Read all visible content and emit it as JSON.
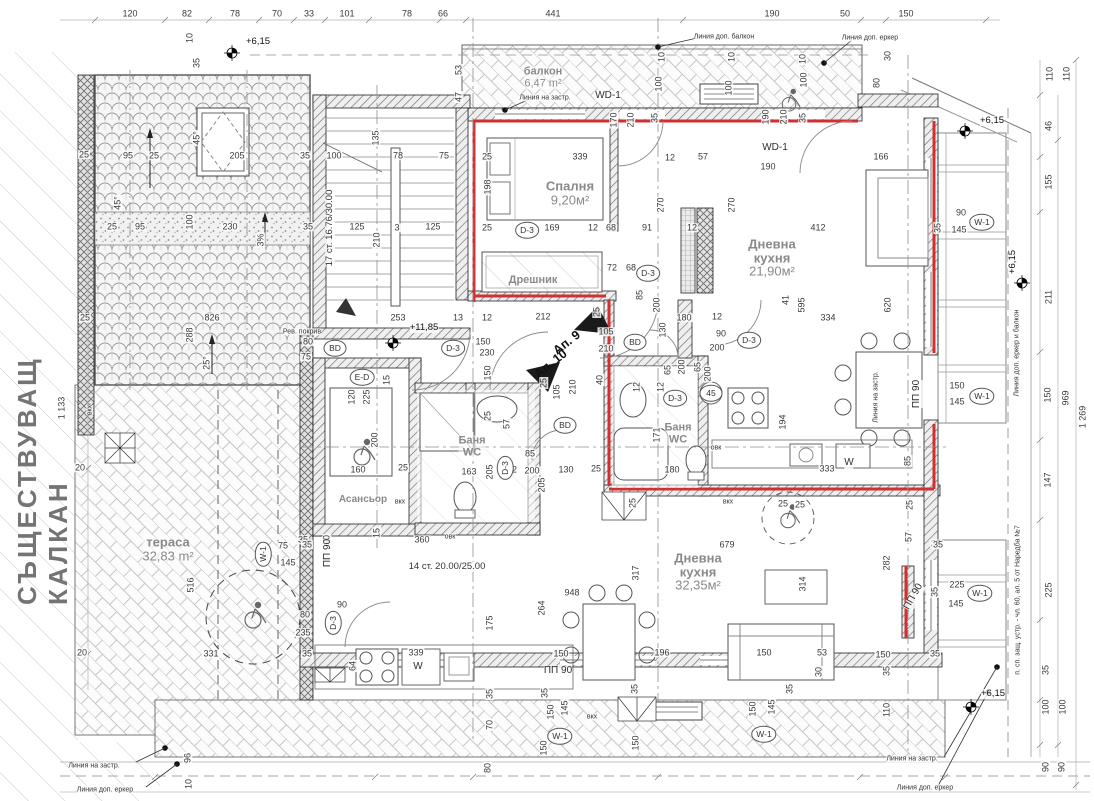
{
  "drawing": {
    "party_wall_label": "СЪЩЕСТВУВАЩ КАЛКАН"
  },
  "rooms": [
    {
      "name": "балкон",
      "area": "6,47 m²",
      "x": 543,
      "y": 78,
      "s": 11
    },
    {
      "name": "Спалня",
      "area": "9,20м²",
      "x": 570,
      "y": 193,
      "s": 13
    },
    {
      "name": "Дрешник",
      "area": "",
      "x": 533,
      "y": 281,
      "s": 11
    },
    {
      "name": "Дневна\nкухня",
      "area": "21,90м²",
      "x": 772,
      "y": 258,
      "s": 13
    },
    {
      "name": "Баня\nWC",
      "area": "",
      "x": 472,
      "y": 447,
      "s": 11
    },
    {
      "name": "Баня\nWC",
      "area": "",
      "x": 678,
      "y": 434,
      "s": 11
    },
    {
      "name": "Асансьор",
      "area": "",
      "x": 363,
      "y": 500,
      "s": 10
    },
    {
      "name": "тераса",
      "area": "32,83 m²",
      "x": 168,
      "y": 549,
      "s": 13
    },
    {
      "name": "Дневна\nкухня",
      "area": "32,35м²",
      "x": 698,
      "y": 572,
      "s": 13
    }
  ],
  "apartments": [
    {
      "label": "Ап. 9",
      "x": 567,
      "y": 343,
      "r": -38
    },
    {
      "label": "Ап. 10",
      "x": 551,
      "y": 364,
      "r": -38
    }
  ],
  "texts": [
    {
      "t": "17 ст. 16.76/30.00",
      "x": 330,
      "y": 228,
      "r": -90
    },
    {
      "t": "14 ст. 20.00/25.00",
      "x": 447,
      "y": 567
    }
  ],
  "levels": [
    {
      "t": "+6,15",
      "x": 258,
      "y": 42
    },
    {
      "t": "+6,15",
      "x": 992,
      "y": 121
    },
    {
      "t": "+6,15",
      "x": 1013,
      "y": 262,
      "r": -90
    },
    {
      "t": "+6,15",
      "x": 993,
      "y": 694
    },
    {
      "t": "+11,85",
      "x": 424,
      "y": 328
    }
  ],
  "markers": [
    {
      "t": "D-3",
      "x": 527,
      "y": 230
    },
    {
      "t": "D-3",
      "x": 648,
      "y": 273
    },
    {
      "t": "D-3",
      "x": 749,
      "y": 340
    },
    {
      "t": "D-3",
      "x": 453,
      "y": 348
    },
    {
      "t": "D-3",
      "x": 505,
      "y": 468,
      "r": -90
    },
    {
      "t": "D-3",
      "x": 333,
      "y": 623,
      "r": -90
    },
    {
      "t": "D-3",
      "x": 675,
      "y": 398
    },
    {
      "t": "BD",
      "x": 335,
      "y": 348
    },
    {
      "t": "BD",
      "x": 635,
      "y": 342
    },
    {
      "t": "BD",
      "x": 565,
      "y": 425
    },
    {
      "t": "E-D",
      "x": 362,
      "y": 377
    },
    {
      "t": "W-1",
      "x": 982,
      "y": 222
    },
    {
      "t": "W-1",
      "x": 982,
      "y": 396
    },
    {
      "t": "W-1",
      "x": 263,
      "y": 554,
      "r": -90
    },
    {
      "t": "W-1",
      "x": 980,
      "y": 593
    },
    {
      "t": "W-1",
      "x": 560,
      "y": 736
    },
    {
      "t": "W-1",
      "x": 764,
      "y": 734
    },
    {
      "t": "45",
      "x": 711,
      "y": 393
    }
  ],
  "tags": [
    {
      "t": "ПП 90",
      "x": 328,
      "y": 553,
      "r": -90
    },
    {
      "t": "ПП 90",
      "x": 917,
      "y": 394,
      "r": -90
    },
    {
      "t": "ПП 90",
      "x": 914,
      "y": 597,
      "r": -60
    },
    {
      "t": "ПП 90",
      "x": 558,
      "y": 671
    },
    {
      "t": "WD-1",
      "x": 608,
      "y": 96
    },
    {
      "t": "WD-1",
      "x": 775,
      "y": 148
    },
    {
      "t": "W",
      "x": 849,
      "y": 463
    },
    {
      "t": "W",
      "x": 418,
      "y": 667
    }
  ],
  "notes": [
    {
      "t": "Линия на застр.",
      "x": 545,
      "y": 98
    },
    {
      "t": "Линия на застр.",
      "x": 876,
      "y": 397,
      "r": -90
    },
    {
      "t": "Линия на застр.",
      "x": 94,
      "y": 766
    },
    {
      "t": "Линия на застр.",
      "x": 912,
      "y": 759
    },
    {
      "t": "Линия доп. балкон",
      "x": 724,
      "y": 37
    },
    {
      "t": "Линия доп. еркер",
      "x": 870,
      "y": 38
    },
    {
      "t": "Линия доп. еркер",
      "x": 105,
      "y": 790
    },
    {
      "t": "Линия доп. еркер",
      "x": 925,
      "y": 788
    },
    {
      "t": "Линия доп. еркер и балкон",
      "x": 1017,
      "y": 353,
      "r": -90
    },
    {
      "t": "п. сп. защ. устр. - чл. 60, ал. 5 от Наредба №7",
      "x": 1018,
      "y": 600,
      "r": -90
    },
    {
      "t": "Рев. покрив",
      "x": 302,
      "y": 332
    },
    {
      "t": "вкх",
      "x": 400,
      "y": 502
    },
    {
      "t": "вкх",
      "x": 728,
      "y": 502
    },
    {
      "t": "вкх",
      "x": 592,
      "y": 717
    },
    {
      "t": "вкх",
      "x": 90,
      "y": 410,
      "r": -90
    },
    {
      "t": "овк",
      "x": 450,
      "y": 537
    },
    {
      "t": "овк",
      "x": 716,
      "y": 448
    }
  ],
  "dims": [
    {
      "t": "120",
      "x": 130,
      "y": 14
    },
    {
      "t": "82",
      "x": 187,
      "y": 14
    },
    {
      "t": "78",
      "x": 235,
      "y": 14
    },
    {
      "t": "70",
      "x": 277,
      "y": 14
    },
    {
      "t": "33",
      "x": 309,
      "y": 14
    },
    {
      "t": "101",
      "x": 347,
      "y": 14
    },
    {
      "t": "78",
      "x": 407,
      "y": 14
    },
    {
      "t": "66",
      "x": 443,
      "y": 14
    },
    {
      "t": "441",
      "x": 553,
      "y": 14
    },
    {
      "t": "190",
      "x": 772,
      "y": 14
    },
    {
      "t": "50",
      "x": 845,
      "y": 14
    },
    {
      "t": "150",
      "x": 906,
      "y": 14
    },
    {
      "t": "10",
      "x": 190,
      "y": 38,
      "r": -90
    },
    {
      "t": "35",
      "x": 197,
      "y": 63,
      "r": -90
    },
    {
      "t": "53",
      "x": 459,
      "y": 70,
      "r": -90
    },
    {
      "t": "47",
      "x": 459,
      "y": 97,
      "r": -90
    },
    {
      "t": "10",
      "x": 662,
      "y": 57,
      "r": -90
    },
    {
      "t": "10",
      "x": 732,
      "y": 57,
      "r": -90
    },
    {
      "t": "10",
      "x": 803,
      "y": 59,
      "r": -90
    },
    {
      "t": "100",
      "x": 659,
      "y": 84,
      "r": -90
    },
    {
      "t": "100",
      "x": 729,
      "y": 88,
      "r": -90
    },
    {
      "t": "100",
      "x": 804,
      "y": 80,
      "r": -90
    },
    {
      "t": "30",
      "x": 888,
      "y": 56,
      "r": -90
    },
    {
      "t": "80",
      "x": 877,
      "y": 83,
      "r": -90
    },
    {
      "t": "170",
      "x": 614,
      "y": 120,
      "r": -90
    },
    {
      "t": "210",
      "x": 631,
      "y": 120,
      "r": -90
    },
    {
      "t": "35",
      "x": 655,
      "y": 118,
      "r": -90
    },
    {
      "t": "190",
      "x": 766,
      "y": 117,
      "r": -90
    },
    {
      "t": "210",
      "x": 784,
      "y": 117,
      "r": -90
    },
    {
      "t": "35",
      "x": 803,
      "y": 118,
      "r": -90
    },
    {
      "t": "190",
      "x": 768,
      "y": 167
    },
    {
      "t": "110",
      "x": 1050,
      "y": 74,
      "r": -90
    },
    {
      "t": "110",
      "x": 1067,
      "y": 74,
      "r": -90
    },
    {
      "t": "46",
      "x": 1049,
      "y": 126,
      "r": -90
    },
    {
      "t": "155",
      "x": 1049,
      "y": 182,
      "r": -90
    },
    {
      "t": "211",
      "x": 1049,
      "y": 297,
      "r": -90
    },
    {
      "t": "150",
      "x": 1048,
      "y": 395,
      "r": -90
    },
    {
      "t": "147",
      "x": 1048,
      "y": 480,
      "r": -90
    },
    {
      "t": "969",
      "x": 1066,
      "y": 398,
      "r": -90
    },
    {
      "t": "1 269",
      "x": 1083,
      "y": 417,
      "r": -90
    },
    {
      "t": "25",
      "x": 84,
      "y": 155
    },
    {
      "t": "95",
      "x": 128,
      "y": 156
    },
    {
      "t": "25",
      "x": 154,
      "y": 156
    },
    {
      "t": "205",
      "x": 237,
      "y": 156
    },
    {
      "t": "35",
      "x": 305,
      "y": 156
    },
    {
      "t": "100",
      "x": 334,
      "y": 156
    },
    {
      "t": "135",
      "x": 376,
      "y": 138,
      "r": -90
    },
    {
      "t": "78",
      "x": 398,
      "y": 156
    },
    {
      "t": "75",
      "x": 444,
      "y": 156
    },
    {
      "t": "25",
      "x": 487,
      "y": 157
    },
    {
      "t": "339",
      "x": 580,
      "y": 157
    },
    {
      "t": "166",
      "x": 881,
      "y": 157
    },
    {
      "t": "198",
      "x": 488,
      "y": 187,
      "r": -90
    },
    {
      "t": "12",
      "x": 670,
      "y": 158
    },
    {
      "t": "57",
      "x": 703,
      "y": 157
    },
    {
      "t": "45°",
      "x": 118,
      "y": 203,
      "r": -90
    },
    {
      "t": "45°",
      "x": 197,
      "y": 138,
      "r": -90
    },
    {
      "t": "100",
      "x": 190,
      "y": 222,
      "r": -90
    },
    {
      "t": "230",
      "x": 230,
      "y": 227
    },
    {
      "t": "3%",
      "x": 261,
      "y": 240,
      "r": -90
    },
    {
      "t": "35",
      "x": 308,
      "y": 227
    },
    {
      "t": "25",
      "x": 112,
      "y": 227
    },
    {
      "t": "95",
      "x": 140,
      "y": 227
    },
    {
      "t": "826",
      "x": 212,
      "y": 318
    },
    {
      "t": "288",
      "x": 190,
      "y": 335,
      "r": -90
    },
    {
      "t": "25°",
      "x": 207,
      "y": 363,
      "r": -90
    },
    {
      "t": "25",
      "x": 85,
      "y": 318
    },
    {
      "t": "20",
      "x": 80,
      "y": 468
    },
    {
      "t": "20",
      "x": 82,
      "y": 653
    },
    {
      "t": "1 133",
      "x": 62,
      "y": 408,
      "r": -90
    },
    {
      "t": "25",
      "x": 487,
      "y": 228
    },
    {
      "t": "169",
      "x": 552,
      "y": 228
    },
    {
      "t": "12",
      "x": 593,
      "y": 228
    },
    {
      "t": "68",
      "x": 611,
      "y": 228
    },
    {
      "t": "91",
      "x": 647,
      "y": 228
    },
    {
      "t": "12",
      "x": 692,
      "y": 228
    },
    {
      "t": "270",
      "x": 661,
      "y": 205,
      "r": -90
    },
    {
      "t": "270",
      "x": 732,
      "y": 205,
      "r": -90
    },
    {
      "t": "412",
      "x": 818,
      "y": 228
    },
    {
      "t": "72",
      "x": 612,
      "y": 268
    },
    {
      "t": "68",
      "x": 631,
      "y": 268
    },
    {
      "t": "125",
      "x": 357,
      "y": 227
    },
    {
      "t": "3",
      "x": 397,
      "y": 228
    },
    {
      "t": "125",
      "x": 433,
      "y": 227
    },
    {
      "t": "210",
      "x": 377,
      "y": 240,
      "r": -90
    },
    {
      "t": "253",
      "x": 398,
      "y": 318
    },
    {
      "t": "13",
      "x": 458,
      "y": 318
    },
    {
      "t": "12",
      "x": 487,
      "y": 318
    },
    {
      "t": "212",
      "x": 543,
      "y": 317
    },
    {
      "t": "25",
      "x": 597,
      "y": 312,
      "r": -90
    },
    {
      "t": "105",
      "x": 606,
      "y": 332
    },
    {
      "t": "210",
      "x": 606,
      "y": 349
    },
    {
      "t": "85",
      "x": 640,
      "y": 295,
      "r": -90
    },
    {
      "t": "200",
      "x": 657,
      "y": 305,
      "r": -90
    },
    {
      "t": "180",
      "x": 684,
      "y": 318
    },
    {
      "t": "130",
      "x": 663,
      "y": 330,
      "r": -90
    },
    {
      "t": "12",
      "x": 717,
      "y": 317
    },
    {
      "t": "90",
      "x": 721,
      "y": 334
    },
    {
      "t": "200",
      "x": 717,
      "y": 348
    },
    {
      "t": "65",
      "x": 698,
      "y": 367,
      "r": -90
    },
    {
      "t": "200",
      "x": 708,
      "y": 374,
      "r": -90
    },
    {
      "t": "334",
      "x": 828,
      "y": 318
    },
    {
      "t": "620",
      "x": 888,
      "y": 305,
      "r": -90
    },
    {
      "t": "41",
      "x": 786,
      "y": 300,
      "r": -90
    },
    {
      "t": "595",
      "x": 802,
      "y": 305,
      "r": -90
    },
    {
      "t": "150",
      "x": 483,
      "y": 342
    },
    {
      "t": "230",
      "x": 487,
      "y": 353
    },
    {
      "t": "150",
      "x": 488,
      "y": 373,
      "r": -90
    },
    {
      "t": "80",
      "x": 308,
      "y": 342
    },
    {
      "t": "75",
      "x": 306,
      "y": 357
    },
    {
      "t": "120",
      "x": 352,
      "y": 397,
      "r": -90
    },
    {
      "t": "225",
      "x": 367,
      "y": 397,
      "r": -90
    },
    {
      "t": "15",
      "x": 387,
      "y": 380,
      "r": -90
    },
    {
      "t": "25",
      "x": 544,
      "y": 383,
      "r": -90
    },
    {
      "t": "105",
      "x": 557,
      "y": 392,
      "r": -90
    },
    {
      "t": "210",
      "x": 573,
      "y": 387,
      "r": -90
    },
    {
      "t": "40",
      "x": 600,
      "y": 380,
      "r": -90
    },
    {
      "t": "25",
      "x": 488,
      "y": 416,
      "r": -90
    },
    {
      "t": "57",
      "x": 507,
      "y": 424,
      "r": -90
    },
    {
      "t": "12",
      "x": 637,
      "y": 387,
      "r": -90
    },
    {
      "t": "12",
      "x": 661,
      "y": 387,
      "r": -90
    },
    {
      "t": "65",
      "x": 668,
      "y": 370,
      "r": -90
    },
    {
      "t": "200",
      "x": 682,
      "y": 367,
      "r": -90
    },
    {
      "t": "194",
      "x": 783,
      "y": 422,
      "r": -90
    },
    {
      "t": "171",
      "x": 657,
      "y": 435,
      "r": -90
    },
    {
      "t": "200",
      "x": 375,
      "y": 440,
      "r": -90
    },
    {
      "t": "160",
      "x": 358,
      "y": 470
    },
    {
      "t": "25",
      "x": 403,
      "y": 468
    },
    {
      "t": "163",
      "x": 469,
      "y": 472
    },
    {
      "t": "205",
      "x": 490,
      "y": 472,
      "r": -90
    },
    {
      "t": "12",
      "x": 512,
      "y": 470
    },
    {
      "t": "85",
      "x": 530,
      "y": 454
    },
    {
      "t": "200",
      "x": 532,
      "y": 471
    },
    {
      "t": "205",
      "x": 542,
      "y": 485,
      "r": -90
    },
    {
      "t": "130",
      "x": 566,
      "y": 470
    },
    {
      "t": "25",
      "x": 596,
      "y": 469
    },
    {
      "t": "180",
      "x": 672,
      "y": 470
    },
    {
      "t": "333",
      "x": 827,
      "y": 469
    },
    {
      "t": "85",
      "x": 908,
      "y": 461,
      "r": -90
    },
    {
      "t": "25",
      "x": 910,
      "y": 505,
      "r": -90
    },
    {
      "t": "57",
      "x": 909,
      "y": 537,
      "r": -90
    },
    {
      "t": "35",
      "x": 936,
      "y": 544
    },
    {
      "t": "25",
      "x": 633,
      "y": 503,
      "r": -90
    },
    {
      "t": "25",
      "x": 783,
      "y": 504
    },
    {
      "t": "25",
      "x": 800,
      "y": 505
    },
    {
      "t": "90",
      "x": 961,
      "y": 213
    },
    {
      "t": "145",
      "x": 959,
      "y": 230
    },
    {
      "t": "35",
      "x": 938,
      "y": 228,
      "r": -90
    },
    {
      "t": "150",
      "x": 957,
      "y": 386
    },
    {
      "t": "145",
      "x": 957,
      "y": 402
    },
    {
      "t": "35",
      "x": 303,
      "y": 540
    },
    {
      "t": "90",
      "x": 327,
      "y": 540,
      "r": -90
    },
    {
      "t": "15",
      "x": 377,
      "y": 533,
      "r": -90
    },
    {
      "t": "360",
      "x": 422,
      "y": 540
    },
    {
      "t": "679",
      "x": 727,
      "y": 545
    },
    {
      "t": "516",
      "x": 191,
      "y": 585,
      "r": -90
    },
    {
      "t": "75",
      "x": 283,
      "y": 546
    },
    {
      "t": "145",
      "x": 288,
      "y": 563
    },
    {
      "t": "35",
      "x": 307,
      "y": 545
    },
    {
      "t": "948",
      "x": 572,
      "y": 593
    },
    {
      "t": "264",
      "x": 542,
      "y": 608,
      "r": -90
    },
    {
      "t": "317",
      "x": 636,
      "y": 573,
      "r": -90
    },
    {
      "t": "314",
      "x": 803,
      "y": 584,
      "r": -90
    },
    {
      "t": "150",
      "x": 561,
      "y": 654
    },
    {
      "t": "196",
      "x": 662,
      "y": 653
    },
    {
      "t": "150",
      "x": 764,
      "y": 653
    },
    {
      "t": "53",
      "x": 822,
      "y": 653
    },
    {
      "t": "30",
      "x": 819,
      "y": 672,
      "r": -90
    },
    {
      "t": "35",
      "x": 790,
      "y": 689,
      "r": -90
    },
    {
      "t": "80",
      "x": 305,
      "y": 615
    },
    {
      "t": "235",
      "x": 303,
      "y": 633
    },
    {
      "t": "90",
      "x": 342,
      "y": 605
    },
    {
      "t": "64",
      "x": 353,
      "y": 666,
      "r": -90
    },
    {
      "t": "175",
      "x": 490,
      "y": 623,
      "r": -90
    },
    {
      "t": "339",
      "x": 416,
      "y": 653
    },
    {
      "t": "35",
      "x": 490,
      "y": 694,
      "r": -90
    },
    {
      "t": "70",
      "x": 490,
      "y": 725,
      "r": -90
    },
    {
      "t": "80",
      "x": 488,
      "y": 768,
      "r": -90
    },
    {
      "t": "331",
      "x": 211,
      "y": 654
    },
    {
      "t": "35",
      "x": 307,
      "y": 654
    },
    {
      "t": "96",
      "x": 188,
      "y": 758,
      "r": -90
    },
    {
      "t": "10",
      "x": 189,
      "y": 784,
      "r": -90
    },
    {
      "t": "35",
      "x": 545,
      "y": 693,
      "r": -90
    },
    {
      "t": "150",
      "x": 551,
      "y": 712,
      "r": -90
    },
    {
      "t": "145",
      "x": 565,
      "y": 708,
      "r": -90
    },
    {
      "t": "150",
      "x": 544,
      "y": 748,
      "r": -90
    },
    {
      "t": "35",
      "x": 635,
      "y": 689,
      "r": -90
    },
    {
      "t": "150",
      "x": 636,
      "y": 743,
      "r": -90
    },
    {
      "t": "150",
      "x": 753,
      "y": 709,
      "r": -90
    },
    {
      "t": "145",
      "x": 772,
      "y": 707,
      "r": -90
    },
    {
      "t": "35",
      "x": 938,
      "y": 545
    },
    {
      "t": "282",
      "x": 887,
      "y": 563,
      "r": -90
    },
    {
      "t": "225",
      "x": 957,
      "y": 585
    },
    {
      "t": "145",
      "x": 956,
      "y": 604
    },
    {
      "t": "35",
      "x": 935,
      "y": 592,
      "r": -90
    },
    {
      "t": "150",
      "x": 883,
      "y": 655
    },
    {
      "t": "35",
      "x": 935,
      "y": 654
    },
    {
      "t": "35",
      "x": 887,
      "y": 671,
      "r": -90
    },
    {
      "t": "110",
      "x": 887,
      "y": 710,
      "r": -90
    },
    {
      "t": "100",
      "x": 1046,
      "y": 707,
      "r": -90
    },
    {
      "t": "100",
      "x": 1063,
      "y": 707,
      "r": -90
    },
    {
      "t": "35",
      "x": 1046,
      "y": 670,
      "r": -90
    },
    {
      "t": "225",
      "x": 1049,
      "y": 590,
      "r": -90
    },
    {
      "t": "90",
      "x": 1046,
      "y": 767,
      "r": -90
    },
    {
      "t": "90",
      "x": 1062,
      "y": 767,
      "r": -90
    }
  ]
}
